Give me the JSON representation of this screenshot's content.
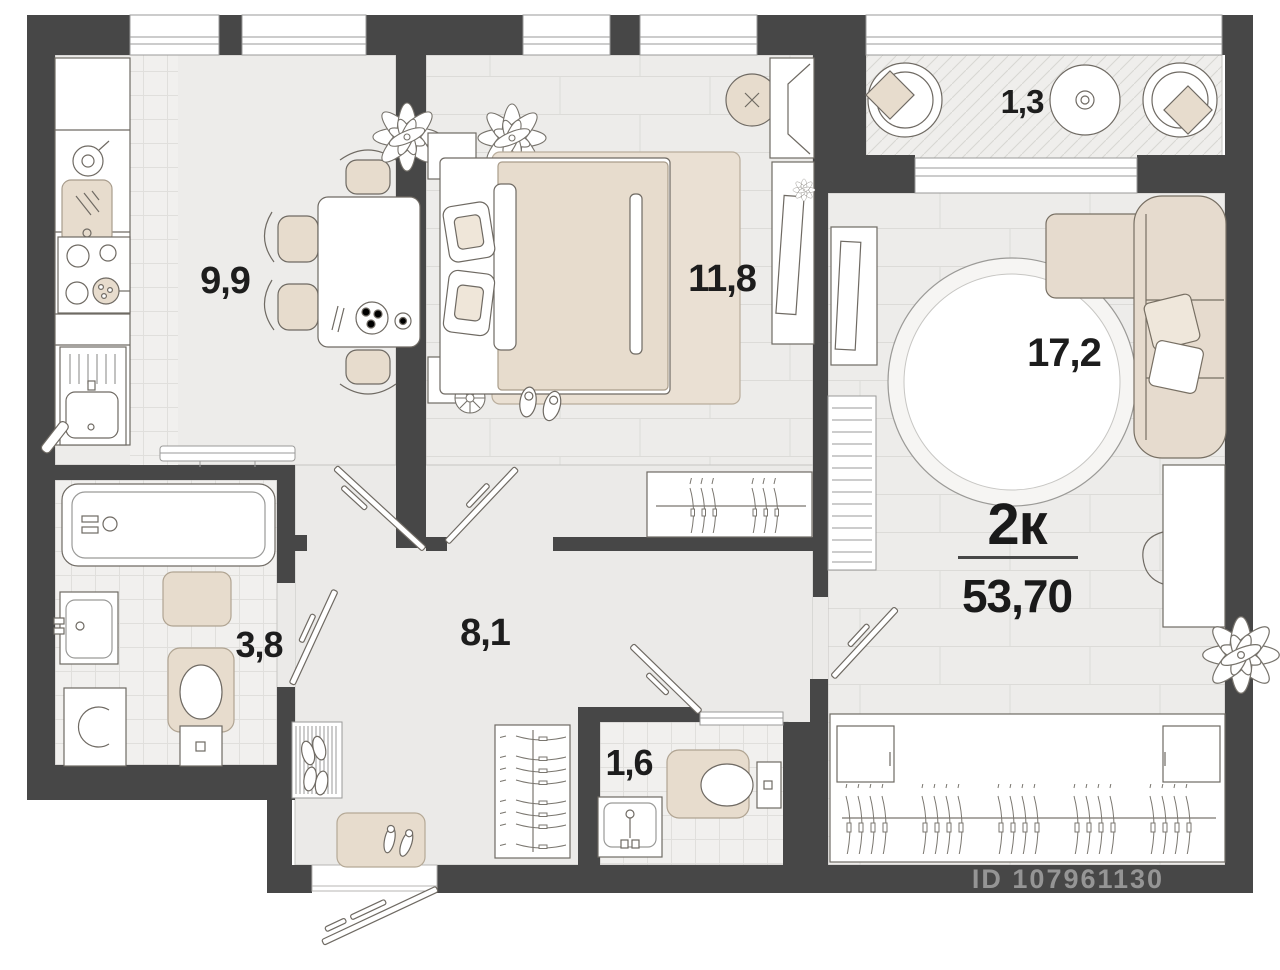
{
  "plan": {
    "type_label": "2к",
    "total_area": "53,70",
    "watermark": "ID 107961130",
    "rooms": [
      {
        "id": "kitchen",
        "area": "9,9"
      },
      {
        "id": "bedroom",
        "area": "11,8"
      },
      {
        "id": "balcony",
        "area": "1,3"
      },
      {
        "id": "living",
        "area": "17,2"
      },
      {
        "id": "bathroom",
        "area": "3,8"
      },
      {
        "id": "hallway",
        "area": "8,1"
      },
      {
        "id": "wc",
        "area": "1,6"
      }
    ],
    "colors": {
      "wall": "#474747",
      "floor": "#edecea",
      "tile": "#f1f0ee",
      "accent_beige": "#e7dccd",
      "outline": "#6f6a63",
      "label_text": "#1d1d1d",
      "watermark": "#a9a9a9"
    }
  }
}
